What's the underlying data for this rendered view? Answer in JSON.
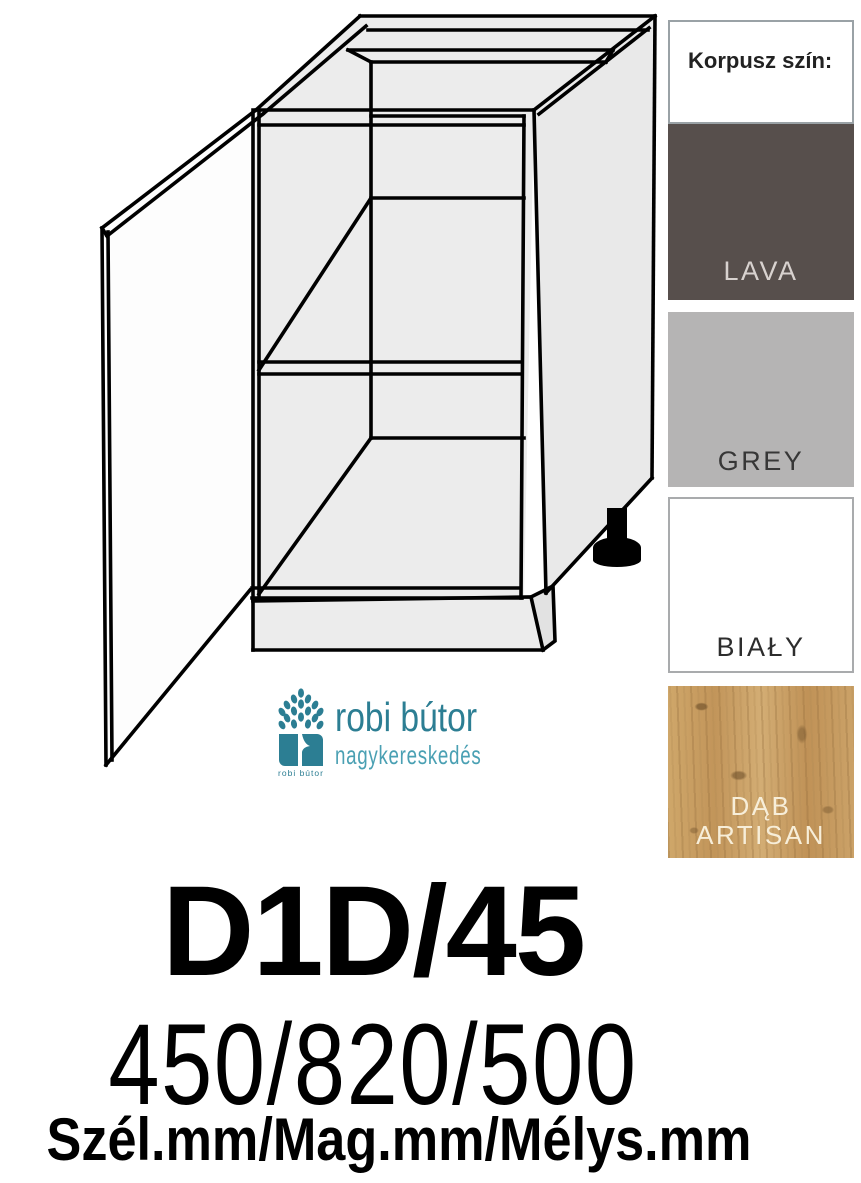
{
  "page": {
    "width": 861,
    "height": 1183,
    "background": "#ffffff"
  },
  "drawing": {
    "description": "line drawing of kitchen base cabinet with one open door, one shelf, open top with front and back rails, plinth and black adjustable foot",
    "carcass_fill": "#ececec",
    "line_color": "#000000"
  },
  "color_panel": {
    "header": "Korpusz szín:",
    "swatches": [
      {
        "label": "LAVA",
        "color": "#574f4c",
        "text_color": "#d8d2cf"
      },
      {
        "label": "GREY",
        "color": "#b5b4b4",
        "text_color": "#373737"
      },
      {
        "label": "BIAŁY",
        "color": "#ffffff",
        "text_color": "#2d2d2d"
      },
      {
        "label": "DĄB ARTISAN",
        "color": "#c89e63",
        "text_color": "#f7eed9",
        "texture": "oak wood grain"
      }
    ]
  },
  "logo": {
    "brand": "robi bútor",
    "subtitle": "nagykereskedés",
    "icon_caption": "robi bútor",
    "teal": "#2c7e93",
    "teal_light": "#4aa0b3"
  },
  "product": {
    "code": "D1D/45",
    "dimensions": "450/820/500",
    "dimensions_label": "Szél.mm/Mag.mm/Mélys.mm"
  }
}
